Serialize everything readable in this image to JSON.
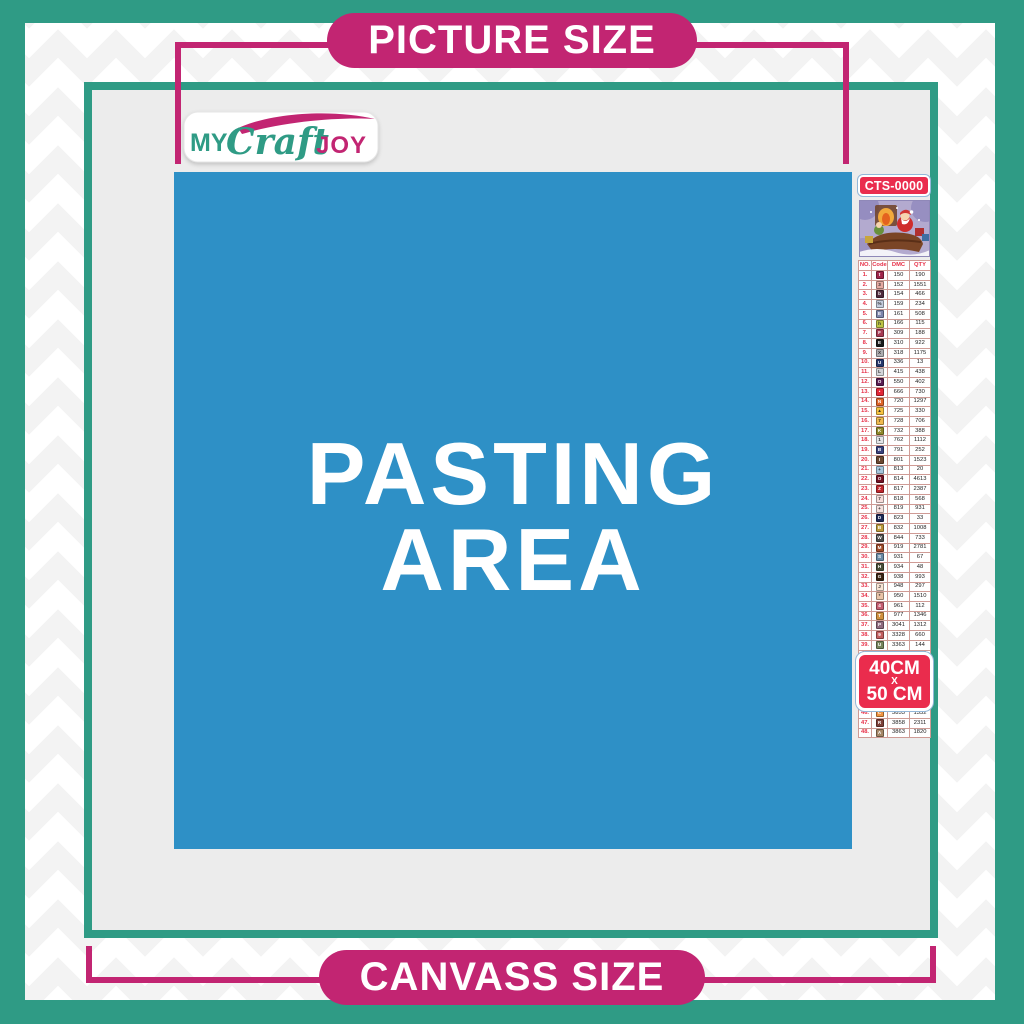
{
  "colors": {
    "teal": "#2f9b85",
    "magenta": "#c22572",
    "blue": "#2e90c6",
    "canvas_gray": "#ececec",
    "badge_red": "#ea2c4d",
    "table_red": "#e73048"
  },
  "top_banner": {
    "label": "PICTURE SIZE"
  },
  "bottom_banner": {
    "label": "CANVASS SIZE"
  },
  "logo": {
    "my": "MY",
    "craft": "Craft",
    "joy": "JOY"
  },
  "pasting_area": {
    "line1": "PASTING",
    "line2": "AREA"
  },
  "sidebar": {
    "product_code": "CTS-0000",
    "size_badge": {
      "line1": "40CM",
      "line2": "X",
      "line3": "50 CM"
    },
    "table": {
      "headers": [
        "NO.",
        "Code",
        "DMC",
        "QTY"
      ],
      "rows": [
        {
          "no": "1.",
          "sym": "t",
          "bg": "#a02349",
          "fg": "#ffffff",
          "dmc": "150",
          "qty": "190"
        },
        {
          "no": "2.",
          "sym": "3",
          "bg": "#e5a9a2",
          "fg": "#333333",
          "dmc": "152",
          "qty": "1551"
        },
        {
          "no": "3.",
          "sym": "b",
          "bg": "#512a3c",
          "fg": "#ffffff",
          "dmc": "154",
          "qty": "466"
        },
        {
          "no": "4.",
          "sym": "%",
          "bg": "#c3cbdc",
          "fg": "#333333",
          "dmc": "159",
          "qty": "234"
        },
        {
          "no": "5.",
          "sym": "E",
          "bg": "#7d86ac",
          "fg": "#ffffff",
          "dmc": "161",
          "qty": "508"
        },
        {
          "no": "6.",
          "sym": "h",
          "bg": "#bcc345",
          "fg": "#333333",
          "dmc": "166",
          "qty": "115"
        },
        {
          "no": "7.",
          "sym": "F",
          "bg": "#a73a53",
          "fg": "#ffffff",
          "dmc": "309",
          "qty": "188"
        },
        {
          "no": "8.",
          "sym": "E",
          "bg": "#1a1a1a",
          "fg": "#ffffff",
          "dmc": "310",
          "qty": "922"
        },
        {
          "no": "9.",
          "sym": "X",
          "bg": "#adadb0",
          "fg": "#333333",
          "dmc": "318",
          "qty": "1175"
        },
        {
          "no": "10.",
          "sym": "U",
          "bg": "#27386d",
          "fg": "#ffffff",
          "dmc": "336",
          "qty": "13"
        },
        {
          "no": "11.",
          "sym": "L",
          "bg": "#d4d4d8",
          "fg": "#333333",
          "dmc": "415",
          "qty": "438"
        },
        {
          "no": "12.",
          "sym": "O",
          "bg": "#5a1c51",
          "fg": "#ffffff",
          "dmc": "550",
          "qty": "402"
        },
        {
          "no": "13.",
          "sym": "•",
          "bg": "#e32636",
          "fg": "#ffffff",
          "dmc": "666",
          "qty": "730"
        },
        {
          "no": "14.",
          "sym": "N",
          "bg": "#e06428",
          "fg": "#ffffff",
          "dmc": "720",
          "qty": "1297"
        },
        {
          "no": "15.",
          "sym": "▲",
          "bg": "#f7c241",
          "fg": "#333333",
          "dmc": "725",
          "qty": "330"
        },
        {
          "no": "16.",
          "sym": "7",
          "bg": "#f0b94e",
          "fg": "#333333",
          "dmc": "728",
          "qty": "706"
        },
        {
          "no": "17.",
          "sym": "K",
          "bg": "#91892a",
          "fg": "#ffffff",
          "dmc": "732",
          "qty": "388"
        },
        {
          "no": "18.",
          "sym": "1",
          "bg": "#e4e4e7",
          "fg": "#333333",
          "dmc": "762",
          "qty": "1112"
        },
        {
          "no": "19.",
          "sym": "B",
          "bg": "#39407c",
          "fg": "#ffffff",
          "dmc": "791",
          "qty": "252"
        },
        {
          "no": "20.",
          "sym": "I",
          "bg": "#6b4730",
          "fg": "#ffffff",
          "dmc": "801",
          "qty": "1523"
        },
        {
          "no": "21.",
          "sym": "+",
          "bg": "#a5c6dd",
          "fg": "#333333",
          "dmc": "813",
          "qty": "20"
        },
        {
          "no": "22.",
          "sym": "O",
          "bg": "#731224",
          "fg": "#ffffff",
          "dmc": "814",
          "qty": "4613"
        },
        {
          "no": "23.",
          "sym": "Z",
          "bg": "#c0272d",
          "fg": "#ffffff",
          "dmc": "817",
          "qty": "2387"
        },
        {
          "no": "24.",
          "sym": "7",
          "bg": "#f6dcd9",
          "fg": "#333333",
          "dmc": "818",
          "qty": "568"
        },
        {
          "no": "25.",
          "sym": "+",
          "bg": "#f4e0dd",
          "fg": "#333333",
          "dmc": "819",
          "qty": "931"
        },
        {
          "no": "26.",
          "sym": "D",
          "bg": "#1f2a56",
          "fg": "#ffffff",
          "dmc": "823",
          "qty": "33"
        },
        {
          "no": "27.",
          "sym": "B",
          "bg": "#bd9b3c",
          "fg": "#ffffff",
          "dmc": "832",
          "qty": "1008"
        },
        {
          "no": "28.",
          "sym": "W",
          "bg": "#4e4d4b",
          "fg": "#ffffff",
          "dmc": "844",
          "qty": "733"
        },
        {
          "no": "29.",
          "sym": "M",
          "bg": "#a04a28",
          "fg": "#ffffff",
          "dmc": "919",
          "qty": "2781"
        },
        {
          "no": "30.",
          "sym": "S",
          "bg": "#6a8aa5",
          "fg": "#ffffff",
          "dmc": "931",
          "qty": "67"
        },
        {
          "no": "31.",
          "sym": "H",
          "bg": "#4a4f38",
          "fg": "#ffffff",
          "dmc": "934",
          "qty": "48"
        },
        {
          "no": "32.",
          "sym": "G",
          "bg": "#3b2413",
          "fg": "#ffffff",
          "dmc": "938",
          "qty": "993"
        },
        {
          "no": "33.",
          "sym": "J",
          "bg": "#f8e3d3",
          "fg": "#333333",
          "dmc": "948",
          "qty": "297"
        },
        {
          "no": "34.",
          "sym": "*",
          "bg": "#e9c3a7",
          "fg": "#333333",
          "dmc": "950",
          "qty": "1510"
        },
        {
          "no": "35.",
          "sym": "4",
          "bg": "#c65e72",
          "fg": "#ffffff",
          "dmc": "961",
          "qty": "112"
        },
        {
          "no": "36.",
          "sym": "T",
          "bg": "#d1913f",
          "fg": "#ffffff",
          "dmc": "977",
          "qty": "1346"
        },
        {
          "no": "37.",
          "sym": "P",
          "bg": "#8f6a7e",
          "fg": "#ffffff",
          "dmc": "3041",
          "qty": "1312"
        },
        {
          "no": "38.",
          "sym": "9",
          "bg": "#c35f5f",
          "fg": "#ffffff",
          "dmc": "3328",
          "qty": "660"
        },
        {
          "no": "39.",
          "sym": "U",
          "bg": "#77855c",
          "fg": "#ffffff",
          "dmc": "3363",
          "qty": "144"
        },
        {
          "no": "40.",
          "sym": "8",
          "bg": "#2a1a0c",
          "fg": "#ffffff",
          "dmc": "3371",
          "qty": "1580"
        },
        {
          "no": "41.",
          "sym": "Y",
          "bg": "#d4cbd8",
          "fg": "#333333",
          "dmc": "3743",
          "qty": "1738"
        },
        {
          "no": "42.",
          "sym": "^",
          "bg": "#f7e7d4",
          "fg": "#333333",
          "dmc": "3770",
          "qty": "40"
        },
        {
          "no": "43.",
          "sym": "V",
          "bg": "#cdb79a",
          "fg": "#333333",
          "dmc": "3782",
          "qty": "617"
        },
        {
          "no": "44.",
          "sym": "2",
          "bg": "#d9dc67",
          "fg": "#333333",
          "dmc": "3819",
          "qty": "119"
        },
        {
          "no": "45.",
          "sym": "✓",
          "bg": "#fbf3c8",
          "fg": "#333333",
          "dmc": "3823",
          "qty": "107"
        },
        {
          "no": "46.",
          "sym": "C",
          "bg": "#ef9442",
          "fg": "#ffffff",
          "dmc": "3853",
          "qty": "1332"
        },
        {
          "no": "47.",
          "sym": "R",
          "bg": "#7d4038",
          "fg": "#ffffff",
          "dmc": "3858",
          "qty": "2311"
        },
        {
          "no": "48.",
          "sym": "A",
          "bg": "#a58666",
          "fg": "#ffffff",
          "dmc": "3863",
          "qty": "1820"
        }
      ]
    }
  }
}
